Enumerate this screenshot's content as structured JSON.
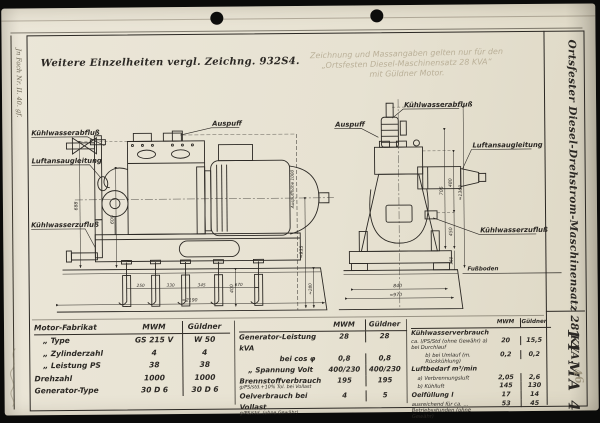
{
  "sheet": {
    "top_note": "Weitere Einzelheiten vergl. Zeichng. 932S4.",
    "stamp_lines": [
      "Zeichnung und Massangaben gelten nur für den",
      "„Ortsfesten Diesel-Maschinensatz 28 KVA“",
      "mit Güldner Motor."
    ],
    "margin_note": "Jn Fach Nr. II. 40. gf.",
    "pencil_note": "46"
  },
  "title_block": {
    "title": "Ortsfester Diesel-Drehstrom-Maschinensatz 28 KVA.",
    "doc_number": "14 MA 4"
  },
  "left_view": {
    "labels": {
      "coolant_out": "Kühlwasserabfluß",
      "air_intake": "Luftansaugleitung",
      "coolant_in": "Kühlwasserzufluß",
      "exhaust": "Auspuff"
    },
    "dims": {
      "h688": "688",
      "h600": "600",
      "b250": "250",
      "b330": "330",
      "b345": "345",
      "b670": "670",
      "h400": "400",
      "w2190": "≈2190",
      "exh_height": "Auspuffhöhe 1000",
      "h935": "≈935",
      "w280": "≈280"
    }
  },
  "right_view": {
    "labels": {
      "coolant_out": "Kühlwasserabfluß",
      "exhaust": "Auspuff",
      "air_intake": "Luftansaugleitung",
      "coolant_in": "Kühlwasserzufluß",
      "floor": "Fußboden"
    },
    "dims": {
      "h705": "705",
      "h480": "480",
      "h450": "450",
      "h1360": "≈1360",
      "h160": "160",
      "w840": "840",
      "w970": "≈970"
    }
  },
  "tables": {
    "motor": {
      "col_label": "Motor-Fabrikat",
      "col1": "MWM",
      "col2": "Güldner",
      "rows": [
        {
          "label": "„  Type",
          "c1": "GS 215 V",
          "c2": "W 50"
        },
        {
          "label": "„  Zylinderzahl",
          "c1": "4",
          "c2": "4"
        },
        {
          "label": "„  Leistung PS",
          "c1": "38",
          "c2": "38"
        },
        {
          "label": "Drehzahl",
          "c1": "1000",
          "c2": "1000"
        },
        {
          "label": "Generator-Type",
          "c1": "30 D 6",
          "c2": "30 D 6"
        }
      ]
    },
    "generator": {
      "col1": "MWM",
      "col2": "Güldner",
      "rows": [
        {
          "label": "Generator-Leistung kVA",
          "c1": "28",
          "c2": "28"
        },
        {
          "label": "bei cos φ",
          "c1": "0,8",
          "c2": "0,8"
        },
        {
          "label": "„  Spannung Volt",
          "c1": "400/230",
          "c2": "400/230"
        },
        {
          "label": "Brennstoffverbrauch",
          "sub": "g/PS/std.+10% Tol. bei Vollast",
          "c1": "195",
          "c2": "195"
        },
        {
          "label": "Oelverbrauch bei Vollast",
          "sub": "g/PS/std. (ohne Gewähr)",
          "c1": "4",
          "c2": "5"
        }
      ]
    },
    "consumption": {
      "col1": "MWM",
      "col2": "Güldner",
      "rows": [
        {
          "label": "Kühlwasserverbrauch"
        },
        {
          "label": "ca. l/PS/Std (ohne Gewähr)  a) bei Durchlauf",
          "c1": "20",
          "c2": "15,5"
        },
        {
          "label": "b) bei Umlauf (m. Rückkühlung)",
          "c1": "0,2",
          "c2": "0,2"
        },
        {
          "label": "Luftbedarf m³/min"
        },
        {
          "label": "a) Verbrennungsluft",
          "c1": "2,05",
          "c2": "2,6"
        },
        {
          "label": "b) Kühlluft",
          "c1": "145",
          "c2": "130"
        },
        {
          "label": "Oelfüllung l",
          "c1": "17",
          "c2": "14"
        },
        {
          "label": "ausreichend für ca. … Betriebsstunden (ohne Gewähr)",
          "c1": "53",
          "c2": "45"
        }
      ]
    }
  }
}
